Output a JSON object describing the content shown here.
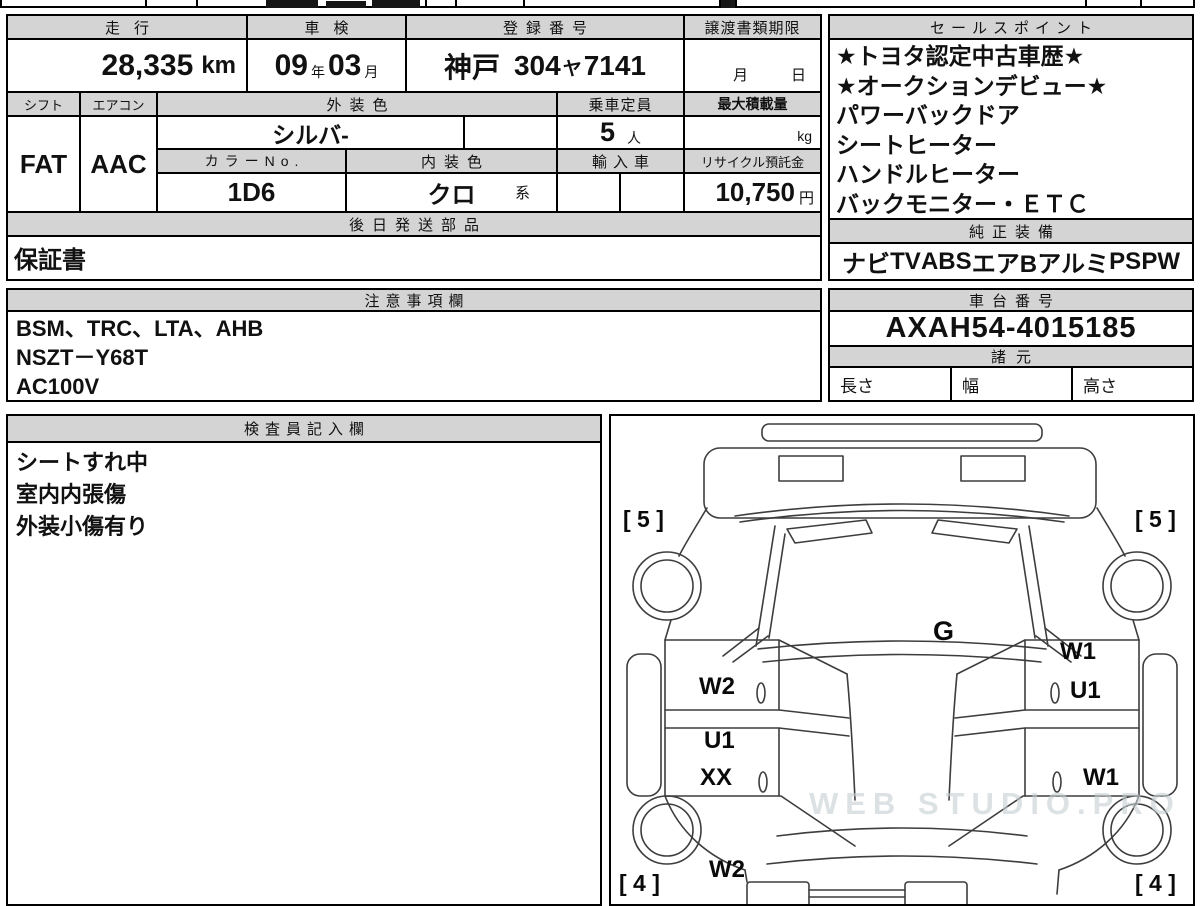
{
  "watermark": "WEB STUDIO.PRO",
  "table": {
    "mileage": {
      "label": "走行",
      "value": "28,335",
      "unit": "km"
    },
    "inspection": {
      "label": "車検",
      "year": "09",
      "year_suffix": "年",
      "month": "03",
      "month_suffix": "月"
    },
    "registration": {
      "label": "登録番号",
      "region": "神戸",
      "class_no": "304",
      "kana": "ヤ",
      "number": "7141"
    },
    "transfer_deadline": {
      "label": "譲渡書類期限",
      "month_suffix": "月",
      "day_suffix": "日"
    },
    "shift": {
      "label": "シフト",
      "value": "FAT"
    },
    "aircon": {
      "label": "エアコン",
      "value": "AAC"
    },
    "exterior_color": {
      "label": "外装色",
      "value": "シルバ-"
    },
    "capacity": {
      "label": "乗車定員",
      "value": "5",
      "unit": "人"
    },
    "max_load": {
      "label": "最大積載量",
      "unit": "kg"
    },
    "color_no": {
      "label": "カラーNo.",
      "value": "1D6"
    },
    "interior_color": {
      "label": "内装色",
      "value": "クロ",
      "suffix": "系"
    },
    "imported": {
      "label": "輸入車"
    },
    "recycle_deposit": {
      "label": "リサイクル預託金",
      "value": "10,750",
      "unit": "円"
    },
    "later_shipping": {
      "label": "後日発送部品",
      "value": "保証書"
    }
  },
  "sales_points": {
    "label": "セールスポイント",
    "items": [
      "★トヨタ認定中古車歴★",
      "★オークションデビュー★",
      "パワーバックドア",
      "シートヒーター",
      "ハンドルヒーター",
      "バックモニター・ＥＴＣ"
    ]
  },
  "equipment": {
    "label": "純正装備",
    "items": [
      "ナビ",
      "TV",
      "ABS",
      "エアB",
      "アルミ",
      "PS",
      "PW"
    ]
  },
  "notes": {
    "label": "注意事項欄",
    "lines": [
      "BSM、TRC、LTA、AHB",
      "NSZT－Y68T",
      "AC100V"
    ]
  },
  "chassis_no": {
    "label": "車台番号",
    "value": "AXAH54-4015185"
  },
  "dimensions": {
    "label": "諸元",
    "length_label": "長さ",
    "width_label": "幅",
    "height_label": "高さ"
  },
  "inspector_notes": {
    "label": "検査員記入欄",
    "lines": [
      "シートすれ中",
      "室内内張傷",
      "外装小傷有り"
    ]
  },
  "diagram": {
    "tire_labels": [
      {
        "text": "[ 5 ]",
        "position": "front-left"
      },
      {
        "text": "[ 5 ]",
        "position": "front-right"
      },
      {
        "text": "[ 4 ]",
        "position": "rear-left"
      },
      {
        "text": "[ 4 ]",
        "position": "rear-right"
      }
    ],
    "damage_marks": [
      {
        "code": "G",
        "area": "windshield"
      },
      {
        "code": "W1",
        "area": "right-front-door-upper"
      },
      {
        "code": "U1",
        "area": "right-front-door"
      },
      {
        "code": "W2",
        "area": "left-front-door"
      },
      {
        "code": "U1",
        "area": "left-rear-door-upper"
      },
      {
        "code": "XX",
        "area": "left-rear-door"
      },
      {
        "code": "W1",
        "area": "right-rear-door"
      },
      {
        "code": "W2",
        "area": "left-rear-quarter"
      }
    ]
  }
}
